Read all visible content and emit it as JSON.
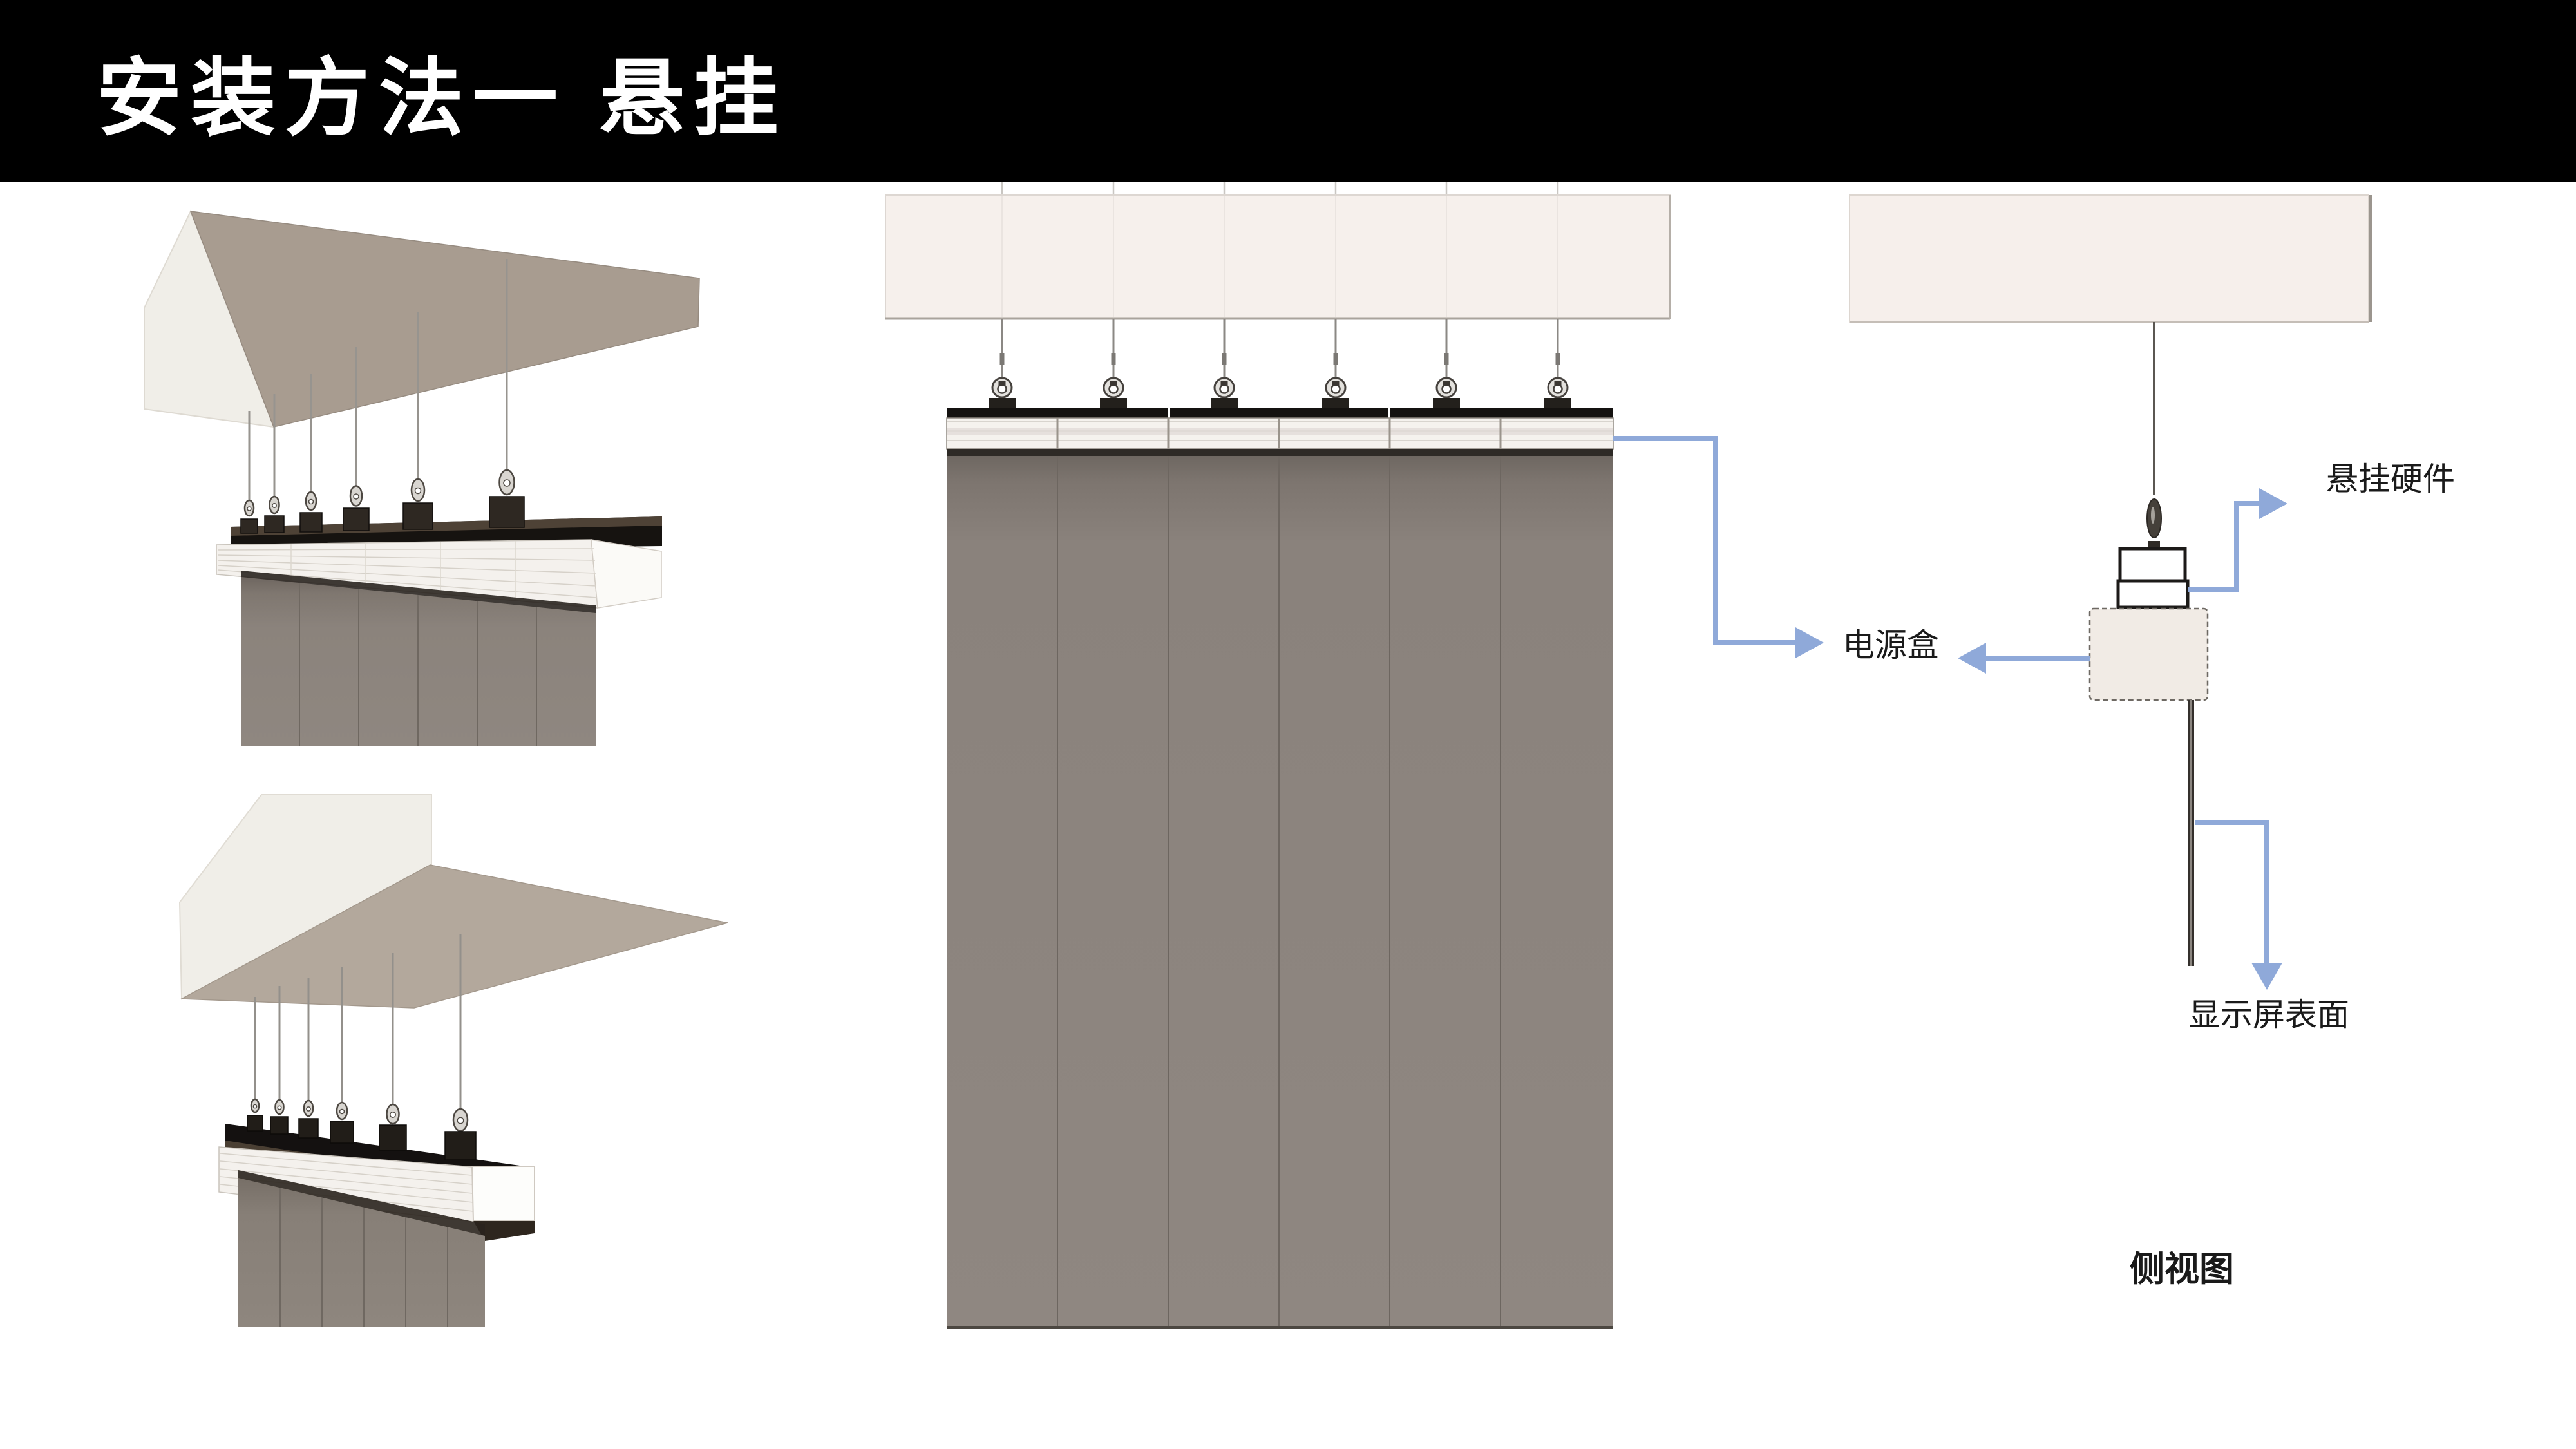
{
  "header": {
    "title": "安装方法一 悬挂"
  },
  "labels": {
    "hanging_hardware": "悬挂硬件",
    "power_box": "电源盒",
    "screen_surface": "显示屏表面",
    "side_view": "侧视图"
  },
  "colors": {
    "header_bg": "#000000",
    "header_fg": "#ffffff",
    "arrow_blue": "#8fa9d9",
    "label_color": "#1a1a1a",
    "ceiling_panel": "#f6f0ec",
    "ceiling_face": "#f0eee8",
    "ceiling_underside": "#ab9f93",
    "display_grey": "#8d857e",
    "rail_white": "#f5f2ee",
    "rail_black": "#17130f"
  }
}
